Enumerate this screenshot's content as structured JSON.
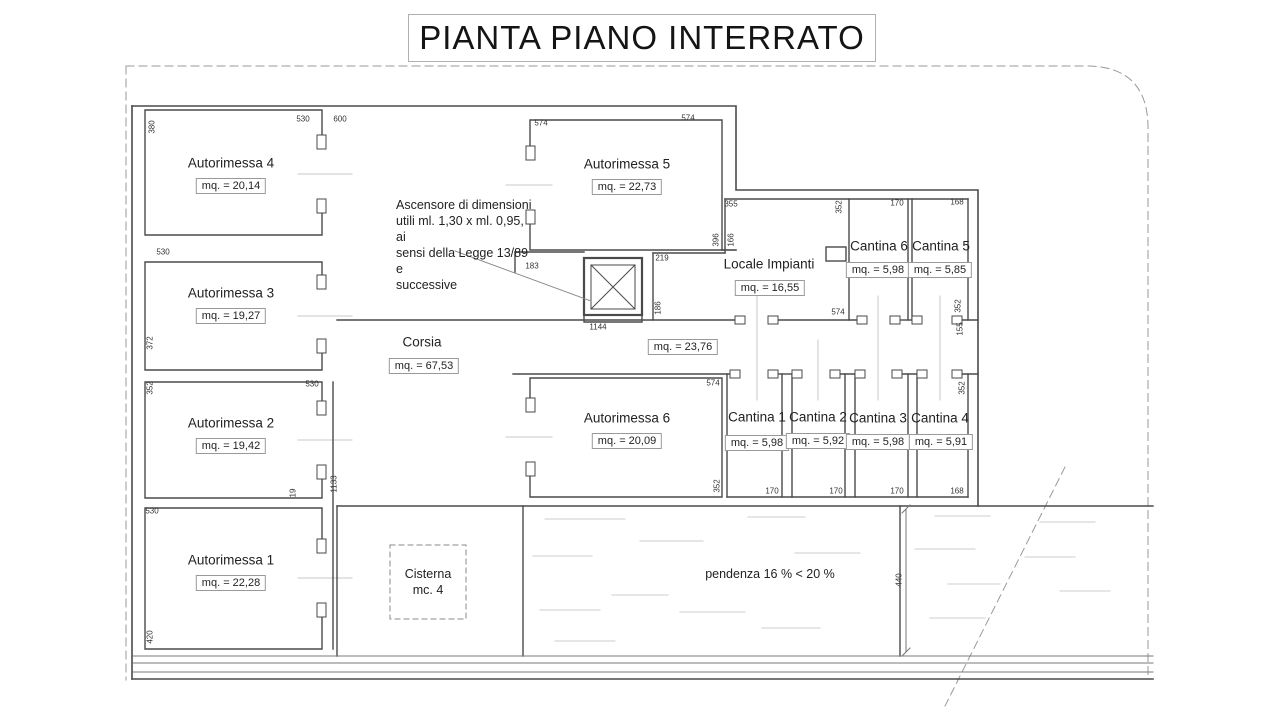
{
  "title": "PIANTA PIANO INTERRATO",
  "rooms": [
    {
      "name": "Autorimessa 4",
      "area": "mq. = 20,14",
      "nx": 231,
      "ny": 163,
      "ax": 231,
      "ay": 186
    },
    {
      "name": "Autorimessa 3",
      "area": "mq. = 19,27",
      "nx": 231,
      "ny": 293,
      "ax": 231,
      "ay": 316
    },
    {
      "name": "Autorimessa 2",
      "area": "mq. = 19,42",
      "nx": 231,
      "ny": 423,
      "ax": 231,
      "ay": 446
    },
    {
      "name": "Autorimessa 1",
      "area": "mq. = 22,28",
      "nx": 231,
      "ny": 560,
      "ax": 231,
      "ay": 583
    },
    {
      "name": "Autorimessa 5",
      "area": "mq. = 22,73",
      "nx": 627,
      "ny": 164,
      "ax": 627,
      "ay": 187
    },
    {
      "name": "Autorimessa 6",
      "area": "mq. = 20,09",
      "nx": 627,
      "ny": 418,
      "ax": 627,
      "ay": 441
    },
    {
      "name": "Corsia",
      "area": "mq. = 67,53",
      "nx": 422,
      "ny": 342,
      "ax": 424,
      "ay": 366
    },
    {
      "name": "Locale Impianti",
      "area": "mq. = 16,55",
      "nx": 769,
      "ny": 264,
      "ax": 770,
      "ay": 288
    },
    {
      "name": "Cantina 6",
      "area": "mq. = 5,98",
      "nx": 879,
      "ny": 246,
      "ax": 878,
      "ay": 270
    },
    {
      "name": "Cantina 5",
      "area": "mq. = 5,85",
      "nx": 941,
      "ny": 246,
      "ax": 940,
      "ay": 270
    },
    {
      "name": "Cantina 1",
      "area": "mq. = 5,98",
      "nx": 757,
      "ny": 417,
      "ax": 757,
      "ay": 443
    },
    {
      "name": "Cantina 2",
      "area": "mq. = 5,92",
      "nx": 818,
      "ny": 417,
      "ax": 818,
      "ay": 441
    },
    {
      "name": "Cantina 3",
      "area": "mq. = 5,98",
      "nx": 878,
      "ny": 418,
      "ax": 878,
      "ay": 442
    },
    {
      "name": "Cantina 4",
      "area": "mq. = 5,91",
      "nx": 940,
      "ny": 418,
      "ax": 941,
      "ay": 442
    }
  ],
  "corridor_area": {
    "area": "mq. = 23,76",
    "ax": 683,
    "ay": 347
  },
  "dimensions": [
    {
      "v": "380",
      "x": 152,
      "y": 127,
      "rot": true
    },
    {
      "v": "530",
      "x": 303,
      "y": 119
    },
    {
      "v": "600",
      "x": 340,
      "y": 119
    },
    {
      "v": "574",
      "x": 541,
      "y": 123
    },
    {
      "v": "574",
      "x": 688,
      "y": 118
    },
    {
      "v": "355",
      "x": 731,
      "y": 204
    },
    {
      "v": "352",
      "x": 839,
      "y": 207,
      "rot": true
    },
    {
      "v": "170",
      "x": 897,
      "y": 203
    },
    {
      "v": "168",
      "x": 957,
      "y": 202
    },
    {
      "v": "396",
      "x": 716,
      "y": 240,
      "rot": true
    },
    {
      "v": "166",
      "x": 731,
      "y": 240,
      "rot": true
    },
    {
      "v": "219",
      "x": 662,
      "y": 258
    },
    {
      "v": "183",
      "x": 532,
      "y": 266
    },
    {
      "v": "186",
      "x": 658,
      "y": 308,
      "rot": true
    },
    {
      "v": "1144",
      "x": 598,
      "y": 327
    },
    {
      "v": "574",
      "x": 838,
      "y": 312
    },
    {
      "v": "352",
      "x": 958,
      "y": 306,
      "rot": true
    },
    {
      "v": "155",
      "x": 960,
      "y": 329,
      "rot": true
    },
    {
      "v": "352",
      "x": 962,
      "y": 388,
      "rot": true
    },
    {
      "v": "574",
      "x": 713,
      "y": 383
    },
    {
      "v": "352",
      "x": 717,
      "y": 486,
      "rot": true
    },
    {
      "v": "530",
      "x": 163,
      "y": 252
    },
    {
      "v": "372",
      "x": 150,
      "y": 343,
      "rot": true
    },
    {
      "v": "352",
      "x": 150,
      "y": 388,
      "rot": true
    },
    {
      "v": "530",
      "x": 312,
      "y": 384
    },
    {
      "v": "19",
      "x": 293,
      "y": 493,
      "rot": true
    },
    {
      "v": "1133",
      "x": 334,
      "y": 484,
      "rot": true
    },
    {
      "v": "530",
      "x": 152,
      "y": 511
    },
    {
      "v": "420",
      "x": 150,
      "y": 637,
      "rot": true
    },
    {
      "v": "170",
      "x": 772,
      "y": 491
    },
    {
      "v": "170",
      "x": 836,
      "y": 491
    },
    {
      "v": "170",
      "x": 897,
      "y": 491
    },
    {
      "v": "168",
      "x": 957,
      "y": 491
    },
    {
      "v": "440",
      "x": 899,
      "y": 580,
      "rot": true
    }
  ],
  "notes": {
    "elevator": {
      "text": "Ascensore di dimensioni\nutili ml. 1,30 x ml. 0,95, ai\nsensi della Legge 13/89 e\nsuccessive"
    },
    "cisterna": {
      "text": "Cisterna\nmc. 4"
    },
    "pendenza": {
      "text": "pendenza 16 % < 20 %"
    }
  }
}
